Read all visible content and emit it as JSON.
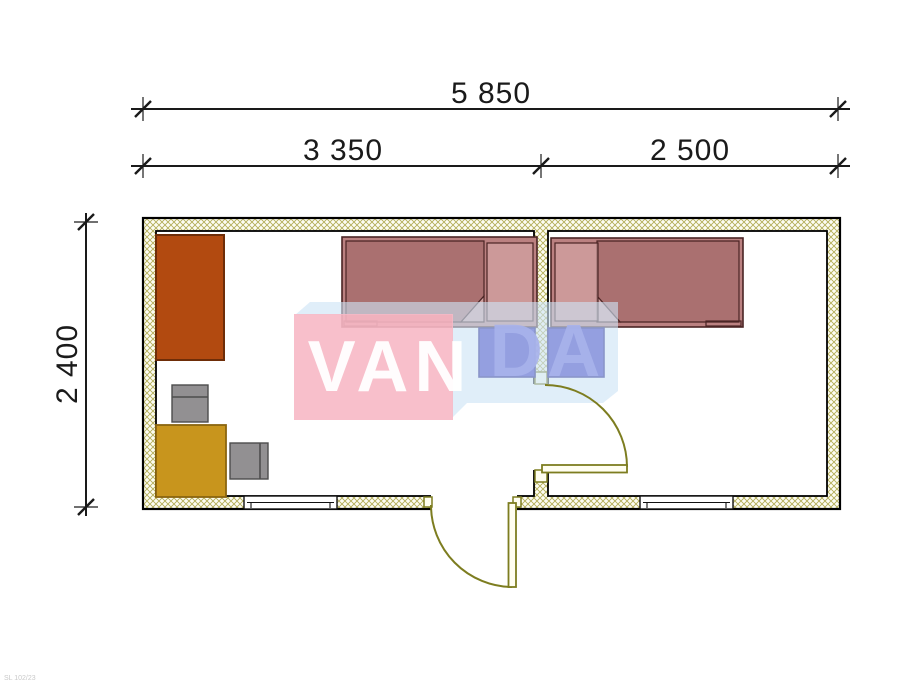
{
  "drawing_type": "container-house floor plan",
  "dimensions": {
    "overall_width": "5 850",
    "room_left_width": "3 350",
    "room_right_width": "2 500",
    "overall_depth": "2 400"
  },
  "watermark": {
    "text_left": "VAN",
    "text_right": "DA",
    "full": "VANDA"
  },
  "corner_mark": "SL 102/23",
  "rooms": [
    {
      "name": "left-room",
      "width_label": "3 350"
    },
    {
      "name": "right-room",
      "width_label": "2 500"
    }
  ],
  "furniture": [
    {
      "name": "wardrobe",
      "room": "left-room"
    },
    {
      "name": "desk-chair",
      "room": "left-room"
    },
    {
      "name": "table",
      "room": "left-room"
    },
    {
      "name": "chair",
      "room": "left-room"
    },
    {
      "name": "single-bed-left",
      "room": "left-room"
    },
    {
      "name": "nightstand-left",
      "room": "left-room"
    },
    {
      "name": "single-bed-right",
      "room": "right-room"
    },
    {
      "name": "nightstand-right",
      "room": "right-room"
    }
  ],
  "openings": [
    {
      "name": "window-left",
      "wall": "bottom"
    },
    {
      "name": "entrance-door",
      "wall": "bottom"
    },
    {
      "name": "interior-door",
      "wall": "partition"
    },
    {
      "name": "window-right",
      "wall": "bottom"
    }
  ],
  "colors": {
    "wall_hatch": "#b3ad57",
    "wall_fill": "#fdfdf3",
    "door": "#7d7d20",
    "door_fill": "#fffef0",
    "wardrobe": "#b24a10",
    "wardrobe_outline": "#6e2d08",
    "table": "#c8951d",
    "table_outline": "#8a6510",
    "chair": "#929092",
    "chair_outline": "#4d4d4d",
    "bed": "#bb8181",
    "bed_outline": "#4a2424",
    "nightstand": "#3730be",
    "nightstand_outline": "#1e1680",
    "watermark_pink": "rgba(247,184,197,0.9)",
    "watermark_blue": "rgba(205,227,245,0.62)",
    "dimension_color": "#1a1a1a"
  }
}
